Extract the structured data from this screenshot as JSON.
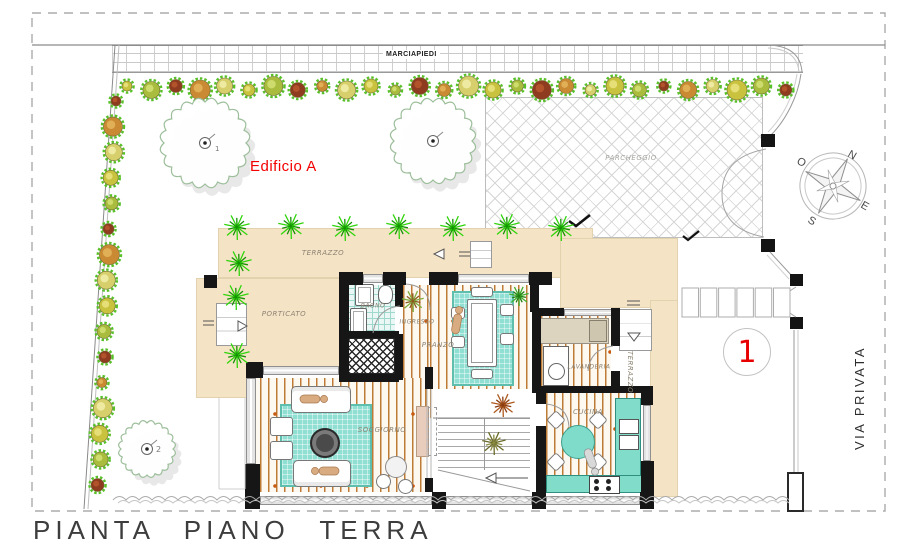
{
  "title": "PIANTA PIANO TERRA",
  "building": {
    "name": "Edificio A",
    "unit_number": "1"
  },
  "site": {
    "sidewalk_label": "MARCIAPIEDI",
    "street_label": "VIA PRIVATA",
    "parking_label": "PARCHEGGIO"
  },
  "compass": {
    "north": "N",
    "east": "E",
    "south": "S",
    "west": "O"
  },
  "rooms": [
    {
      "id": "terrazzo-north",
      "label": "TERRAZZO"
    },
    {
      "id": "porticato",
      "label": "PORTICATO"
    },
    {
      "id": "bagno",
      "label": "BAGNO"
    },
    {
      "id": "ingresso",
      "label": "INGRESSO"
    },
    {
      "id": "pranzo",
      "label": "PRANZO"
    },
    {
      "id": "lavanderia",
      "label": "LAVANDERIA"
    },
    {
      "id": "cucina",
      "label": "CUCINA"
    },
    {
      "id": "soggiorno",
      "label": "SOGGIORNO"
    },
    {
      "id": "terrazzo-east",
      "label": "TERRAZZO"
    }
  ],
  "trees": [
    {
      "label": "1"
    },
    {
      "label": "2"
    }
  ],
  "colors": {
    "accent_red": "#E80000",
    "beige": "#F5E3C6",
    "teal": "#8FDFD2",
    "wood": "#BD7B36"
  }
}
